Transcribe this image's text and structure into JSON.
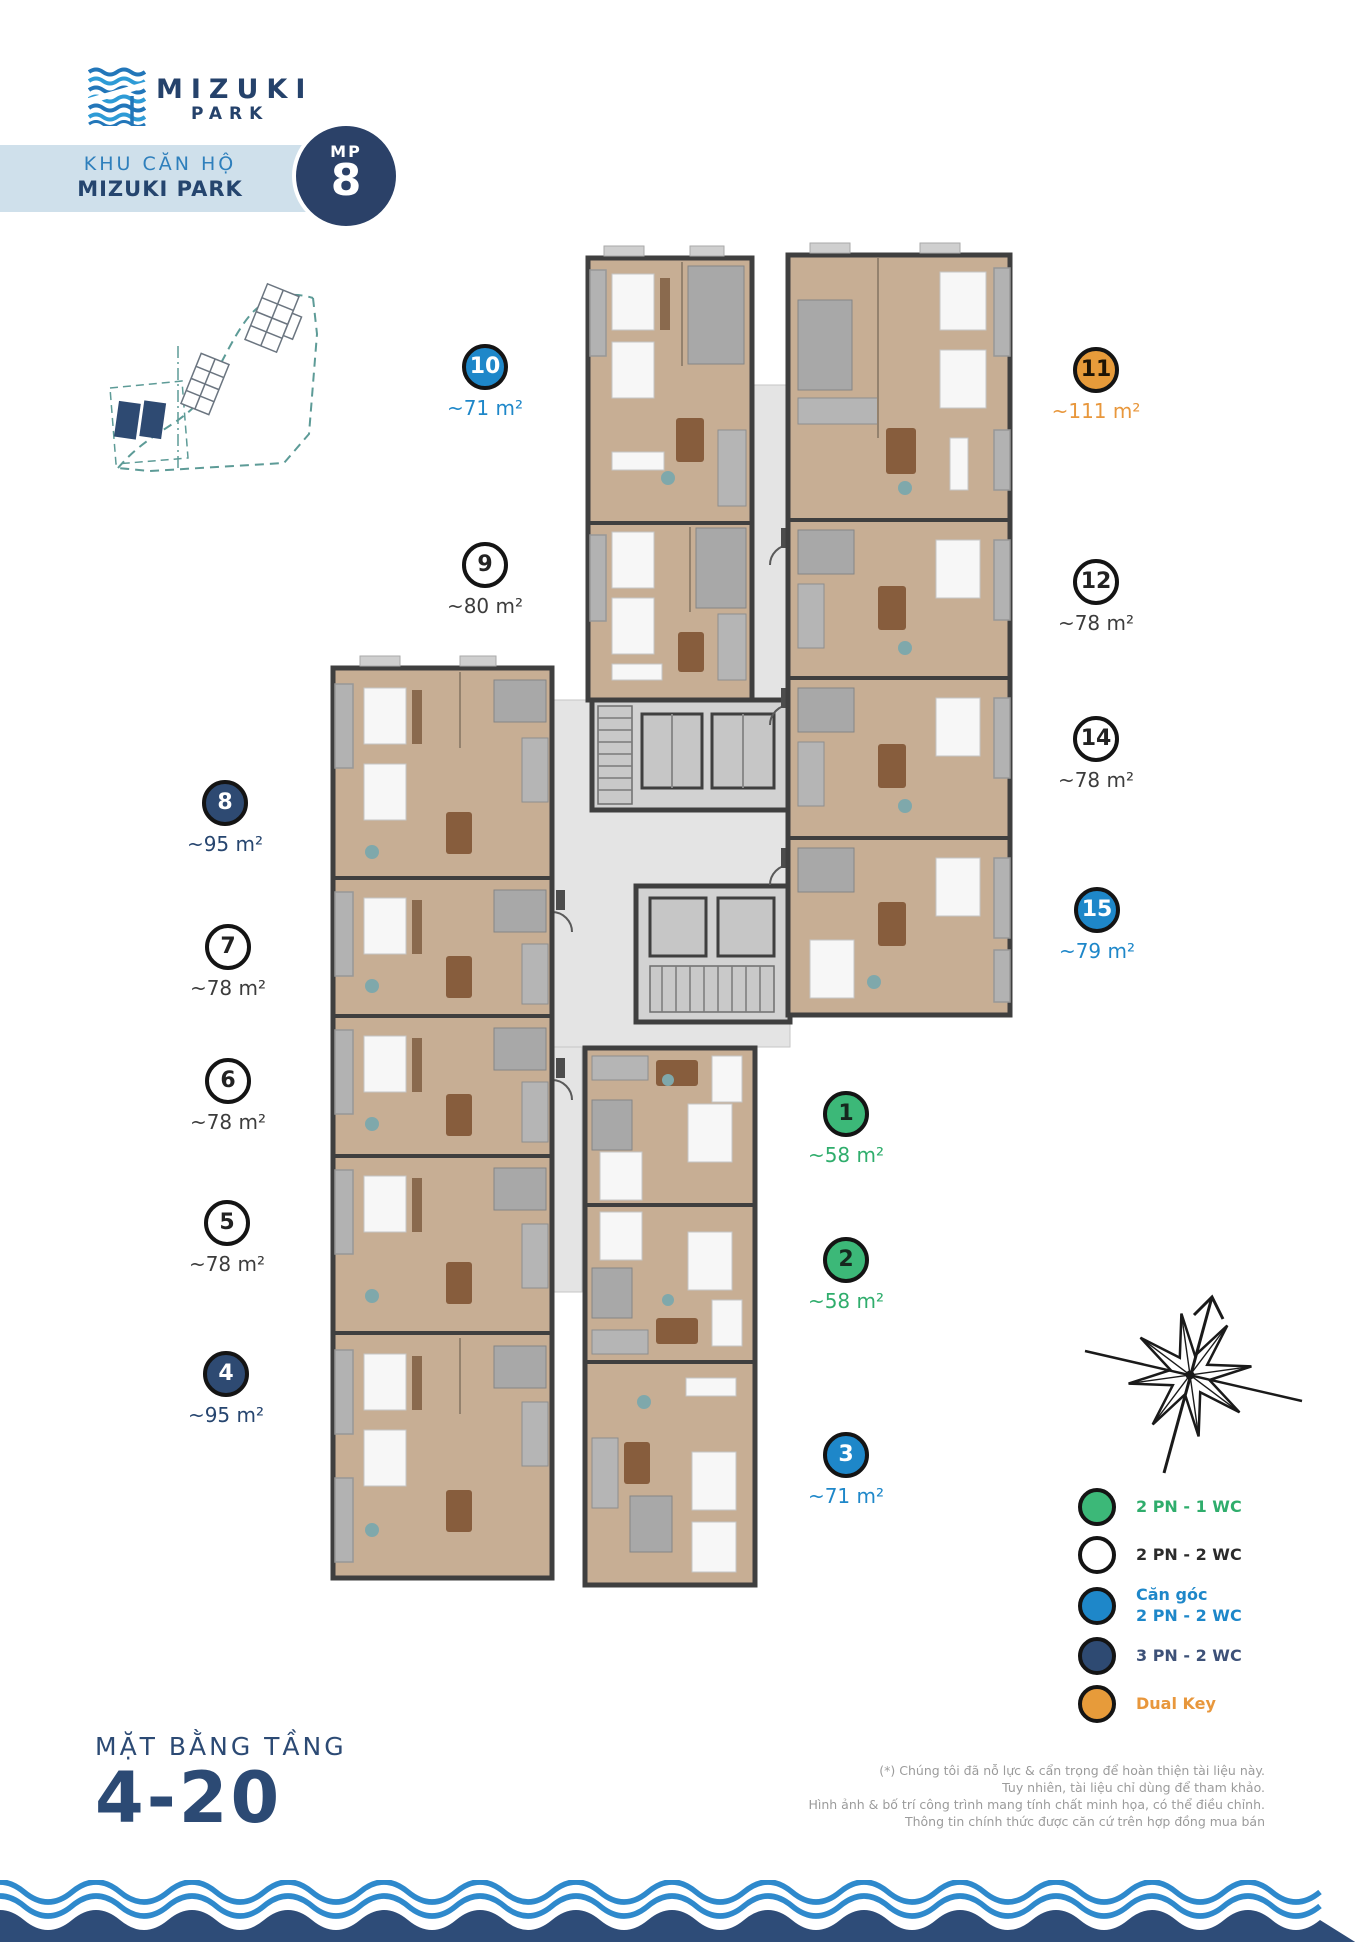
{
  "logo": {
    "title": "MIZUKI",
    "subtitle": "PARK"
  },
  "banner": {
    "line1": "KHU CĂN HỘ",
    "line2": "MIZUKI PARK",
    "badge_label": "MP",
    "badge_number": "8"
  },
  "units": [
    {
      "id": "1",
      "number": "1",
      "area": "~58 m²",
      "type": "2 PN - 1 WC",
      "color": "green"
    },
    {
      "id": "2",
      "number": "2",
      "area": "~58 m²",
      "type": "2 PN - 1 WC",
      "color": "green"
    },
    {
      "id": "3",
      "number": "3",
      "area": "~71 m²",
      "type": "Căn góc 2 PN - 2 WC",
      "color": "blue"
    },
    {
      "id": "4",
      "number": "4",
      "area": "~95 m²",
      "type": "3 PN - 2 WC",
      "color": "navy"
    },
    {
      "id": "5",
      "number": "5",
      "area": "~78 m²",
      "type": "2 PN - 2 WC",
      "color": "white"
    },
    {
      "id": "6",
      "number": "6",
      "area": "~78 m²",
      "type": "2 PN - 2 WC",
      "color": "white"
    },
    {
      "id": "7",
      "number": "7",
      "area": "~78 m²",
      "type": "2 PN - 2 WC",
      "color": "white"
    },
    {
      "id": "8",
      "number": "8",
      "area": "~95 m²",
      "type": "3 PN - 2 WC",
      "color": "navy"
    },
    {
      "id": "9",
      "number": "9",
      "area": "~80 m²",
      "type": "2 PN - 2 WC",
      "color": "white"
    },
    {
      "id": "10",
      "number": "10",
      "area": "~71 m²",
      "type": "Căn góc 2 PN - 2 WC",
      "color": "blue"
    },
    {
      "id": "11",
      "number": "11",
      "area": "~111 m²",
      "type": "Dual Key",
      "color": "orange"
    },
    {
      "id": "12",
      "number": "12",
      "area": "~78 m²",
      "type": "2 PN - 2 WC",
      "color": "white"
    },
    {
      "id": "14",
      "number": "14",
      "area": "~78 m²",
      "type": "2 PN - 2 WC",
      "color": "white"
    },
    {
      "id": "15",
      "number": "15",
      "area": "~79 m²",
      "type": "Căn góc 2 PN - 2 WC",
      "color": "blue"
    }
  ],
  "legend": {
    "items": [
      {
        "line1": "2 PN - 1 WC",
        "color": "#3cb878",
        "text_color": "#2fad6c"
      },
      {
        "line1": "2 PN - 2 WC",
        "color": "#ffffff",
        "text_color": "#2b2b2b"
      },
      {
        "line1": "Căn góc",
        "line2": "2 PN - 2 WC",
        "color": "#1e87c9",
        "text_color": "#1e87c9"
      },
      {
        "line1": "3 PN - 2 WC",
        "color": "#2e4a72",
        "text_color": "#3d5178"
      },
      {
        "line1": "Dual Key",
        "color": "#e79b3a",
        "text_color": "#e8973c"
      }
    ]
  },
  "floor_title": {
    "label": "MẶT BẰNG TẦNG",
    "floors": "4-20"
  },
  "disclaimer": {
    "lines": [
      "(*) Chúng tôi đã nỗ lực & cẩn trọng để hoàn thiện tài liệu này.",
      "Tuy nhiên, tài liệu chỉ dùng để tham khảo.",
      "Hình ảnh & bố trí công trình mang tính chất minh họa, có thể điều chỉnh.",
      "Thông tin chính thức được căn cứ trên hợp đồng mua bán"
    ]
  },
  "colors": {
    "brand_navy": "#2c4a74",
    "badge_navy": "#2b4168",
    "corner_blue": "#1e87c9",
    "green": "#3cb878",
    "orange": "#e79b3a",
    "banner_bg": "#cfe0eb",
    "wave_blue": "#2e89cc",
    "wave_navy": "#2e4c78"
  }
}
